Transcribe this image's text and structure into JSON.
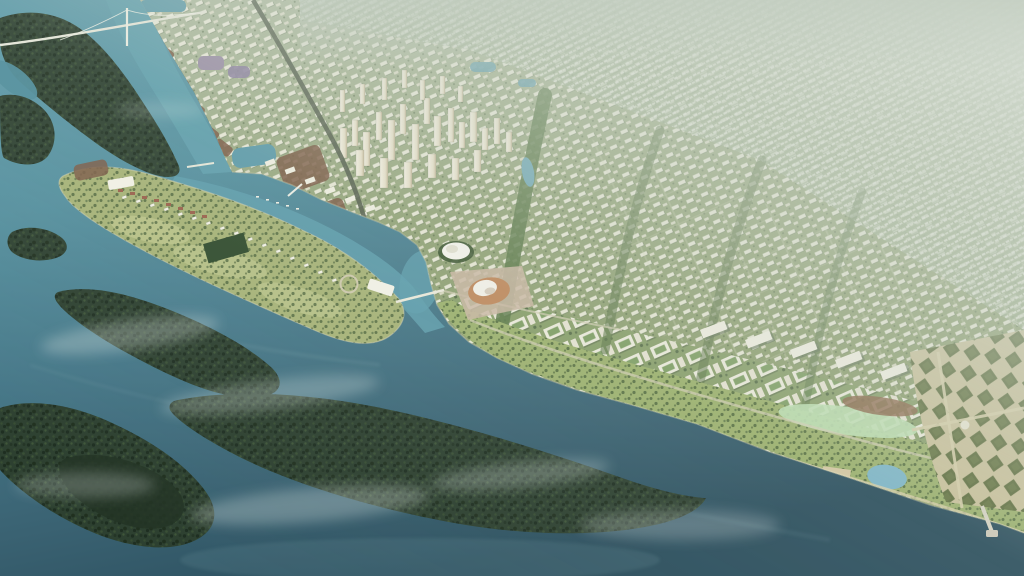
{
  "meta": {
    "title": "Aerial masterplan rendering",
    "alt": "Aerial perspective rendering of a planned riverside city: a dense grid of cream buildings and high-rise towers on the mainland, a long green golf-course peninsula with villas, dark forested delta islands in a wide teal estuary, an orange-roofed stadium, formal diamond-parterre gardens with a pier on the waterfront, a suspension bridge over the river, and distant housing blocks fading into pale haze."
  },
  "scene": {
    "type": "architectural-aerial-rendering",
    "regions": [
      {
        "name": "sky-haze",
        "description": "Atmospheric haze washing out the far city toward the top right"
      },
      {
        "name": "distant-city-grid",
        "description": "Dense low-rise housing grid receding to the horizon"
      },
      {
        "name": "tower-cluster",
        "description": "Cluster of cream high-rise towers in the upper centre"
      },
      {
        "name": "mid-rise-blocks",
        "description": "White perimeter blocks with green courtyards across the plain"
      },
      {
        "name": "river",
        "description": "Bright teal river entering the estuary at the upper left"
      },
      {
        "name": "suspension-bridge",
        "description": "White cable-stayed bridge crossing the river"
      },
      {
        "name": "golf-course-peninsula",
        "description": "Elongated resort island with villas, fairways and a roundabout"
      },
      {
        "name": "stadium",
        "description": "Oval stadium with a sandy-orange roof near the river bend"
      },
      {
        "name": "dome-building",
        "description": "White petal-roofed hall on a lawn"
      },
      {
        "name": "waterfront-park",
        "description": "Linear park band along the southern shoreline"
      },
      {
        "name": "formal-gardens",
        "description": "Diamond parterre gardens with a pier, lower right"
      },
      {
        "name": "forest-islands",
        "description": "Dark forested delta islands in the estuary"
      },
      {
        "name": "estuary-water",
        "description": "Wide teal estuary with drifting mist"
      }
    ]
  },
  "palette": {
    "water_deep": "#2c4f5e",
    "water_main": "#47798a",
    "water_river": "#5f9cab",
    "forest_dark": "#2d4030",
    "land_olive": "#8a9c6a",
    "land_haze_top": "#b3bfa6",
    "building_light": "#f2f0e3",
    "building_shadow": "#66765a",
    "haze": "#cdd6cc",
    "golf_green": "#a7b377",
    "fairway_light": "#bcc489",
    "garden_olive": "#5e6d3d",
    "garden_path": "#cbc29c",
    "stadium_orange": "#c08a5e",
    "roof_red": "#9a5f4a",
    "russet": "#7d5c47",
    "mist": "#dfe9e6"
  }
}
